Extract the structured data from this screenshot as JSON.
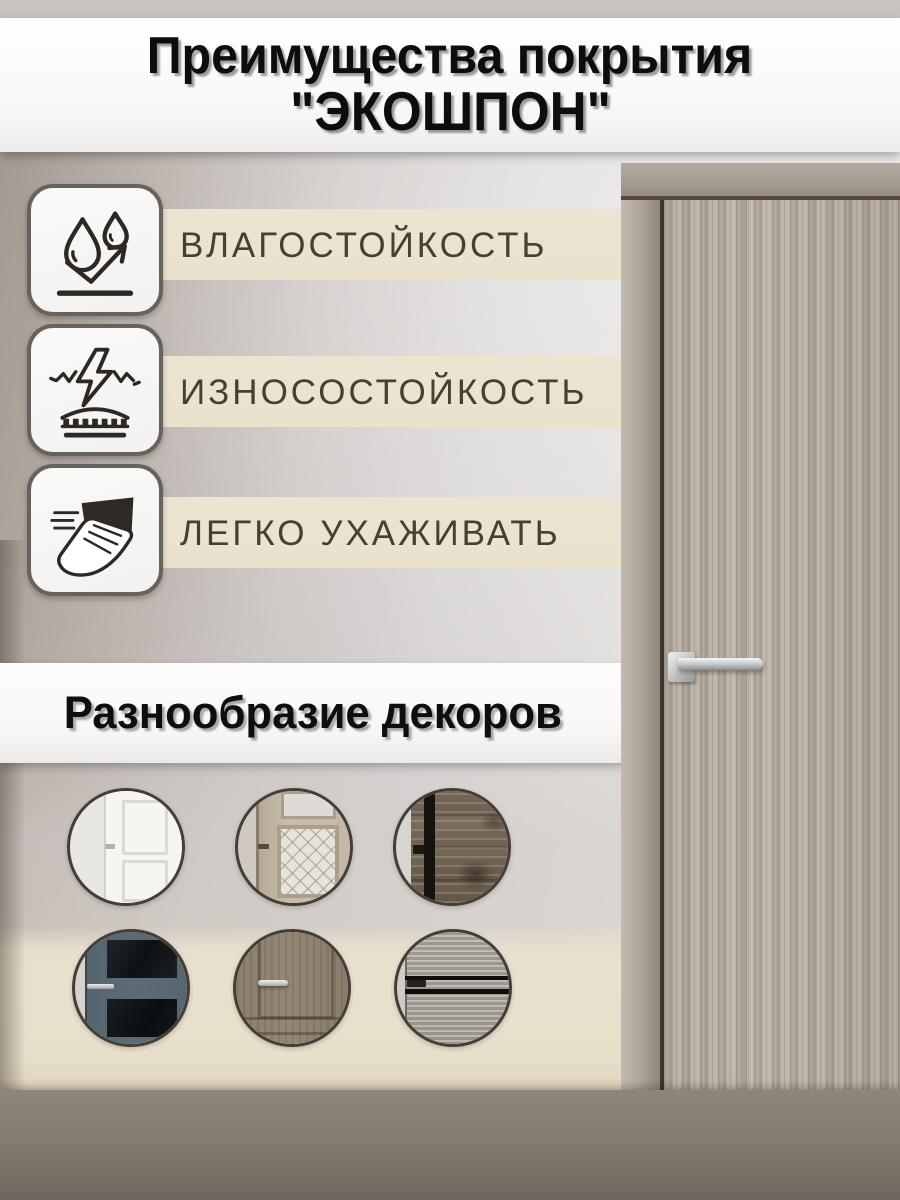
{
  "header": {
    "title_line1": "Преимущества покрытия",
    "title_line2": "\"ЭКОШПОН\""
  },
  "features": {
    "items": [
      {
        "label": "ВЛАГОСТОЙКОСТЬ",
        "icon": "water-drops-icon"
      },
      {
        "label": "ИЗНОСОСТОЙКОСТЬ",
        "icon": "impact-resistance-icon"
      },
      {
        "label": "ЛЕГКО УХАЖИВАТЬ",
        "icon": "wipe-hand-icon"
      }
    ]
  },
  "decors": {
    "title": "Разнообразие декоров",
    "items": [
      {
        "variant": "white-classic",
        "name": "white-paneled-door"
      },
      {
        "variant": "glass-ornament",
        "name": "beige-door-ornate-glass"
      },
      {
        "variant": "dark-rustic",
        "name": "dark-rustic-wood-door"
      },
      {
        "variant": "blue-glass",
        "name": "blue-gray-door-dark-glass"
      },
      {
        "variant": "taupe-classic",
        "name": "taupe-classic-wood-door"
      },
      {
        "variant": "gray-slats",
        "name": "gray-wood-door-black-slats"
      }
    ]
  },
  "footer": {
    "label": "КАЧЕСТВО МАТЕРИАЛА",
    "icon": "shield-check-icon"
  },
  "colors": {
    "cream_strip": "#eae2cd",
    "footer_band": "#857b71",
    "banner_white": "#fbfafa",
    "text_dark": "#483e34",
    "door_wood": "#b3a99e"
  }
}
